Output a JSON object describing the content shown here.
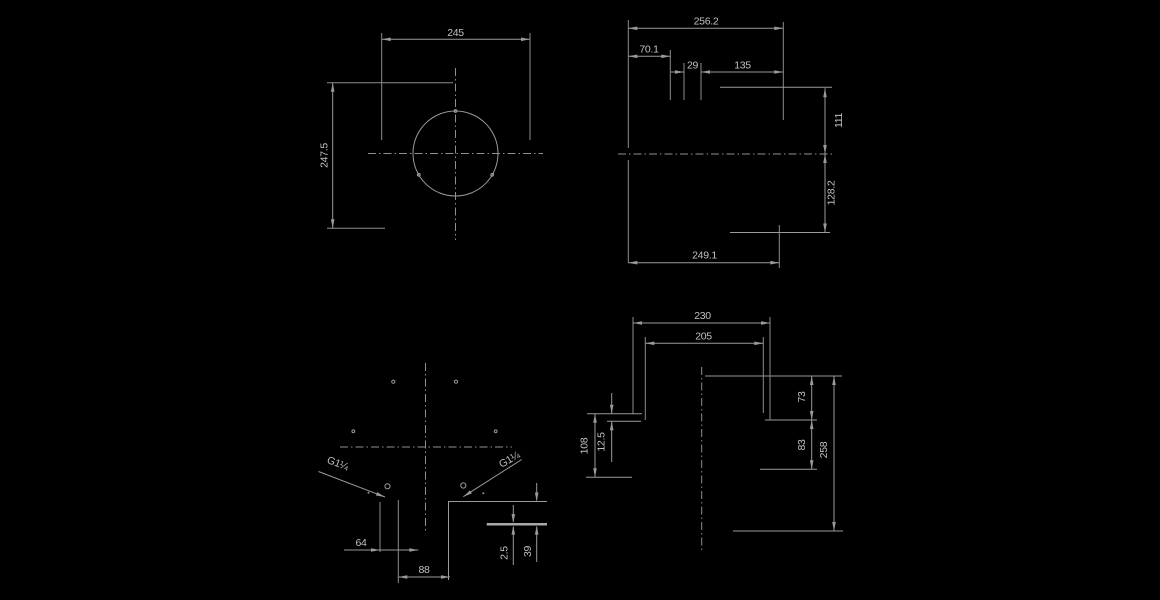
{
  "drawing": {
    "type": "engineering-multiview-dimension-drawing",
    "colors": {
      "background": "#000000",
      "line": "#9a9a9a",
      "text": "#c0c0c0"
    },
    "views": {
      "top": {
        "dims": {
          "width": "245",
          "height": "247.5"
        }
      },
      "front": {
        "dims": {
          "overall_width": "256.2",
          "left_offset": "70.1",
          "notch_width": "29",
          "right_offset": "135",
          "upper_height": "111",
          "lower_height": "128.2",
          "base_width": "249.1"
        }
      },
      "bottom": {
        "thread_left": "G1¼",
        "thread_right": "G1¼",
        "dims": {
          "port_offset": "64",
          "base_width": "88",
          "plate_thickness": "2.5",
          "foot_height": "39"
        }
      },
      "side": {
        "dims": {
          "outer_width": "230",
          "inner_width": "205",
          "lip_height": "12.5",
          "left_height": "108",
          "upper_step": "73",
          "mid_step": "83",
          "overall_height": "258"
        }
      }
    }
  }
}
